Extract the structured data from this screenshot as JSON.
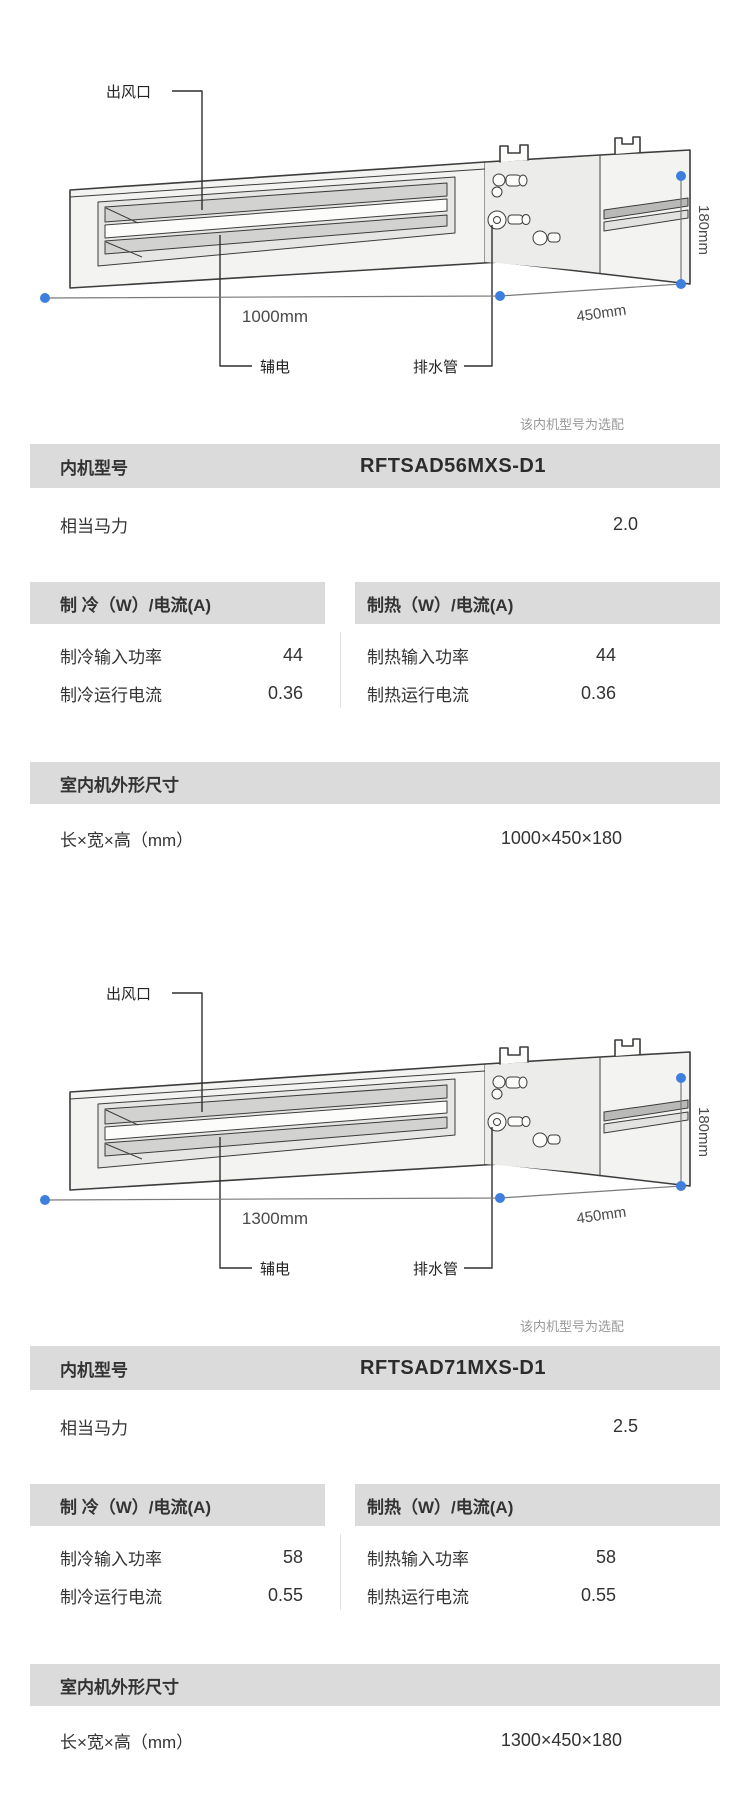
{
  "colors": {
    "bar_gray": "#dbdbdb",
    "dot_blue": "#3e7ede",
    "note_gray": "#999999",
    "text_dark": "#333333"
  },
  "units": [
    {
      "diagram": {
        "outlet_label": "出风口",
        "aux_label": "辅电",
        "drain_label": "排水管",
        "length_label": "1000mm",
        "depth_label": "450mm",
        "height_label": "180mm"
      },
      "note": "该内机型号为选配",
      "model_row": {
        "label": "内机型号",
        "value": "RFTSAD56MXS-D1"
      },
      "hp_row": {
        "label": "相当马力",
        "value": "2.0"
      },
      "cooling": {
        "header": "制 冷（W）/电流(A)",
        "rows": [
          {
            "label": "制冷输入功率",
            "value": "44"
          },
          {
            "label": "制冷运行电流",
            "value": "0.36"
          }
        ]
      },
      "heating": {
        "header": "制热（W）/电流(A)",
        "rows": [
          {
            "label": "制热输入功率",
            "value": "44"
          },
          {
            "label": "制热运行电流",
            "value": "0.36"
          }
        ]
      },
      "dimensions": {
        "header": "室内机外形尺寸",
        "label": "长×宽×高（mm）",
        "value": "1000×450×180"
      }
    },
    {
      "diagram": {
        "outlet_label": "出风口",
        "aux_label": "辅电",
        "drain_label": "排水管",
        "length_label": "1300mm",
        "depth_label": "450mm",
        "height_label": "180mm"
      },
      "note": "该内机型号为选配",
      "model_row": {
        "label": "内机型号",
        "value": "RFTSAD71MXS-D1"
      },
      "hp_row": {
        "label": "相当马力",
        "value": "2.5"
      },
      "cooling": {
        "header": "制 冷（W）/电流(A)",
        "rows": [
          {
            "label": "制冷输入功率",
            "value": "58"
          },
          {
            "label": "制冷运行电流",
            "value": "0.55"
          }
        ]
      },
      "heating": {
        "header": "制热（W）/电流(A)",
        "rows": [
          {
            "label": "制热输入功率",
            "value": "58"
          },
          {
            "label": "制热运行电流",
            "value": "0.55"
          }
        ]
      },
      "dimensions": {
        "header": "室内机外形尺寸",
        "label": "长×宽×高（mm）",
        "value": "1300×450×180"
      }
    }
  ]
}
